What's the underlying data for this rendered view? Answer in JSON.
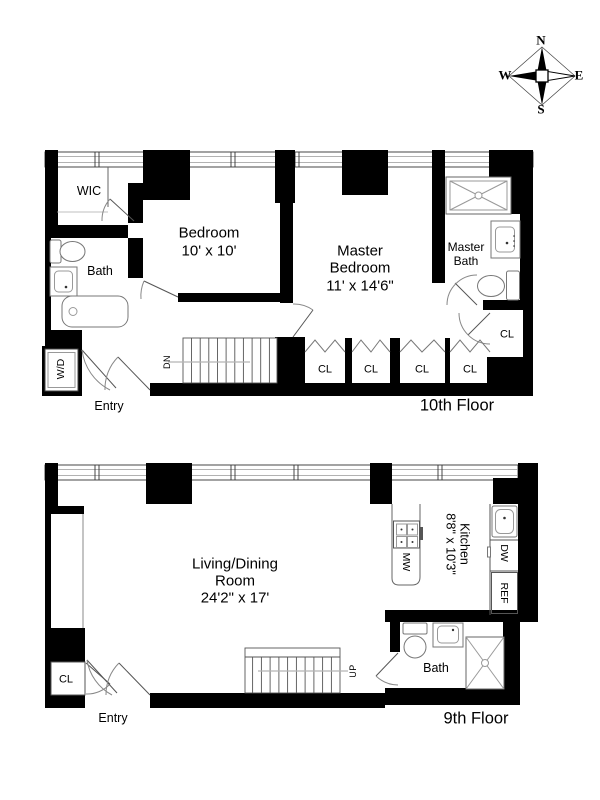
{
  "compass": {
    "n": "N",
    "e": "E",
    "s": "S",
    "w": "W"
  },
  "floor_10": {
    "floor_label": "10th Floor",
    "wic": "WIC",
    "bath": "Bath",
    "bedroom": [
      "Bedroom",
      "10' x 10'"
    ],
    "master_bedroom": [
      "Master",
      "Bedroom",
      "11' x 14'6\""
    ],
    "master_bath": [
      "Master",
      "Bath"
    ],
    "washer_dryer": "W/D",
    "stair_direction": "DN",
    "entry": "Entry",
    "closets": [
      "CL",
      "CL",
      "CL",
      "CL"
    ],
    "closet_hall": "CL"
  },
  "floor_9": {
    "floor_label": "9th Floor",
    "living_dining": [
      "Living/Dining",
      "Room",
      "24'2\" x 17'"
    ],
    "kitchen": [
      "Kitchen",
      "8'8\" x 10'3\""
    ],
    "microwave": "MW",
    "dishwasher": "DW",
    "refrigerator": "REF",
    "bath": "Bath",
    "closet": "CL",
    "stair_direction": "UP",
    "entry": "Entry"
  }
}
